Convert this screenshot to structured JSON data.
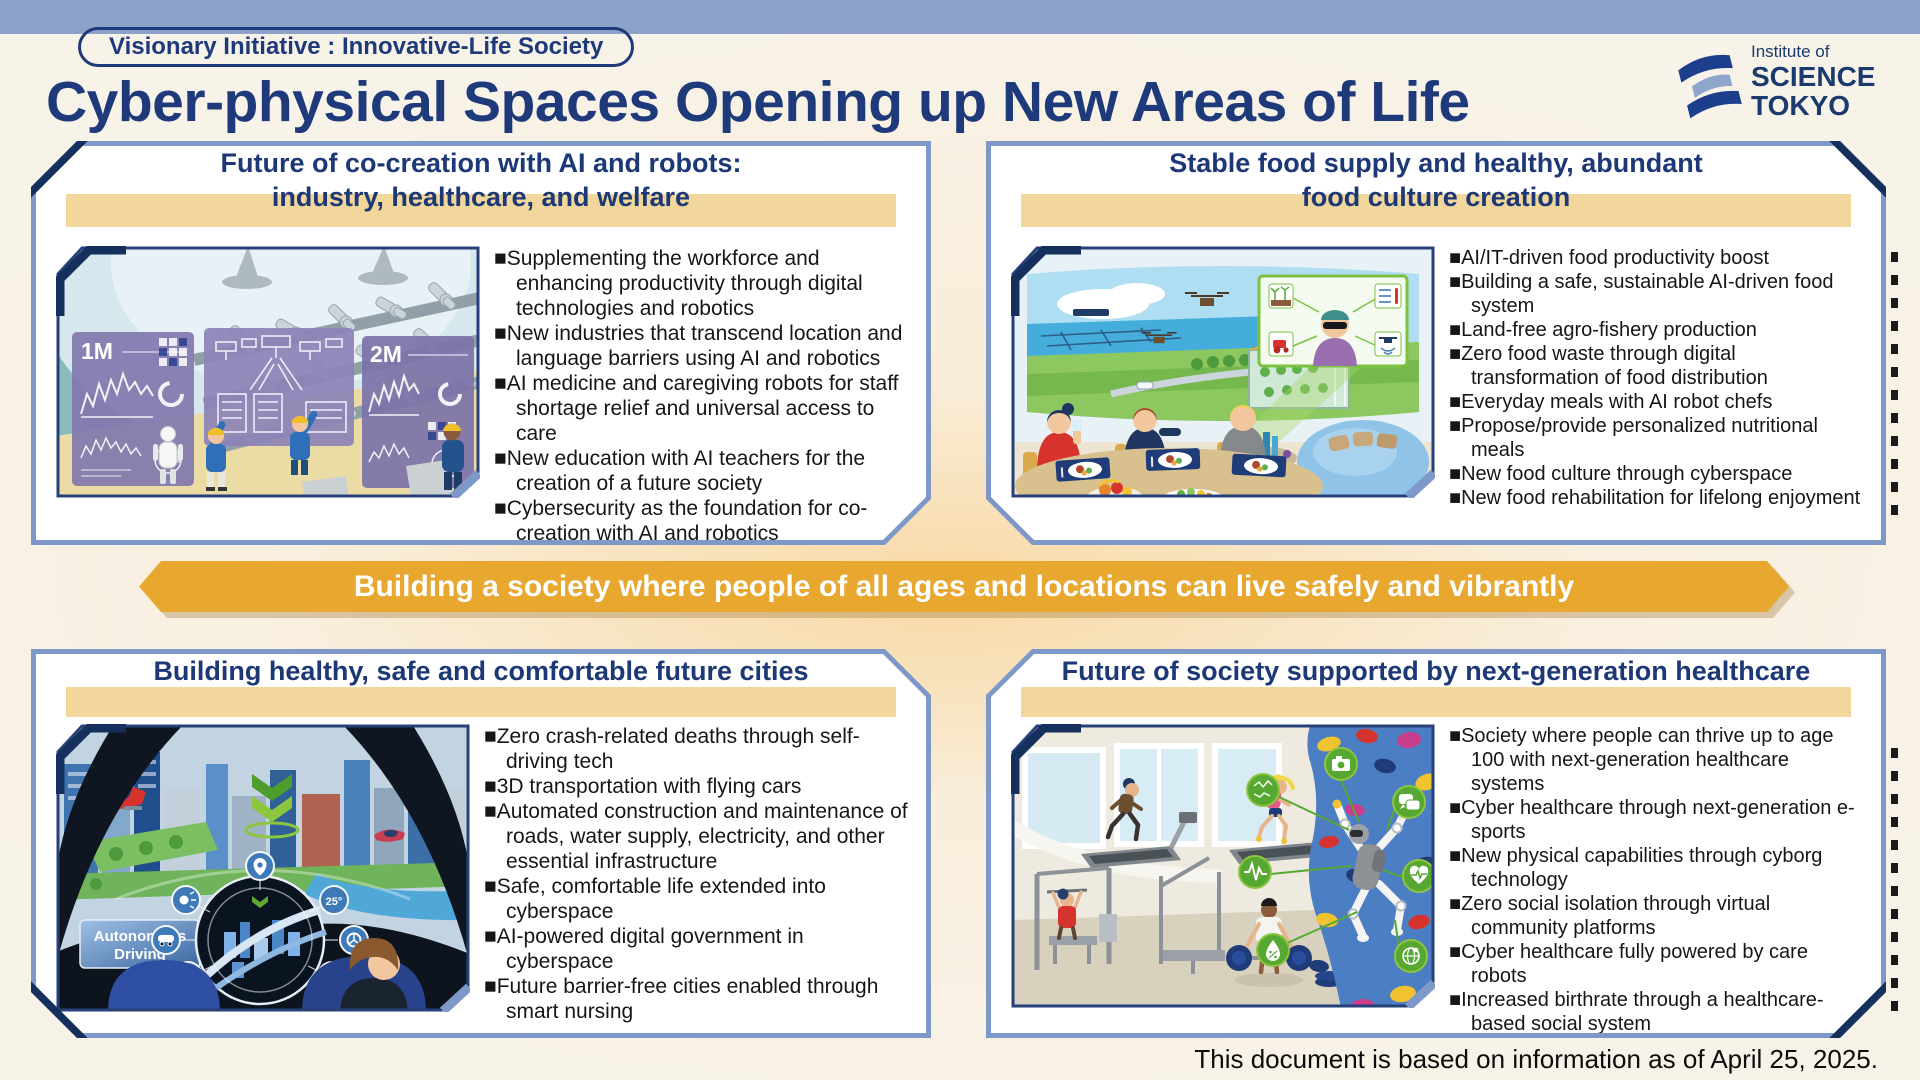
{
  "colors": {
    "navy": "#1E3A7B",
    "panel_border": "#7E99C9",
    "corner_accent": "#16305E",
    "gold_bar": "#F1D79B",
    "banner": "#E8A72E",
    "topbar": "#8CA2C9",
    "background": "#F8F3E9"
  },
  "header": {
    "badge_label": "Visionary Initiative : Innovative-Life Society",
    "title": "Cyber-physical Spaces Opening up New Areas of Life",
    "logo": {
      "line1": "Institute of",
      "line2": "SCIENCE",
      "line3": "TOKYO"
    }
  },
  "panels": [
    {
      "title_lines": [
        "Future of co-creation with AI and robots:",
        "industry, healthcare, and welfare"
      ],
      "bullets": [
        "Supplementing the workforce and enhancing productivity through digital technologies and robotics",
        "New industries that transcend location and language barriers using AI and robotics",
        "AI medicine and caregiving robots for staff shortage relief and universal access to care",
        "New education with AI teachers for the creation of a future society",
        "Cybersecurity as the foundation for co-creation with AI and robotics"
      ]
    },
    {
      "title_lines": [
        "Stable food supply and healthy, abundant",
        "food culture creation"
      ],
      "bullets": [
        "AI/IT-driven food productivity boost",
        "Building a safe, sustainable AI-driven food system",
        "Land-free agro-fishery production",
        "Zero food waste through digital transformation of food distribution",
        "Everyday meals with AI robot chefs",
        "Propose/provide personalized nutritional meals",
        "New food culture through cyberspace",
        "New food rehabilitation for lifelong enjoyment"
      ]
    },
    {
      "title_lines": [
        "Building healthy, safe and comfortable future cities"
      ],
      "bullets": [
        "Zero crash-related deaths through self-driving tech",
        "3D transportation with flying cars",
        "Automated construction and maintenance of roads, water supply, electricity, and other essential infrastructure",
        "Safe, comfortable life extended into cyberspace",
        "AI-powered digital government in cyberspace",
        "Future barrier-free cities enabled through smart nursing"
      ]
    },
    {
      "title_lines": [
        "Future of society supported by next-generation healthcare"
      ],
      "bullets": [
        "Society where people can thrive up to age 100 with next-generation healthcare systems",
        "Cyber healthcare through next-generation e-sports",
        "New physical capabilities through cyborg technology",
        "Zero social isolation through virtual community platforms",
        "Cyber healthcare fully powered by care robots",
        "Increased birthrate through a healthcare-based social system"
      ]
    }
  ],
  "banner": {
    "text": "Building a society where people of all ages and locations can live safely and vibrantly"
  },
  "illustrations": {
    "factory": {
      "screen_label_1": "1M",
      "screen_label_2": "2M"
    },
    "cockpit": {
      "badge_line1": "Autonomous",
      "badge_line2": "Driving",
      "temperature": "25°"
    }
  },
  "footer": {
    "note": "This document is based on information as of April 25, 2025."
  }
}
